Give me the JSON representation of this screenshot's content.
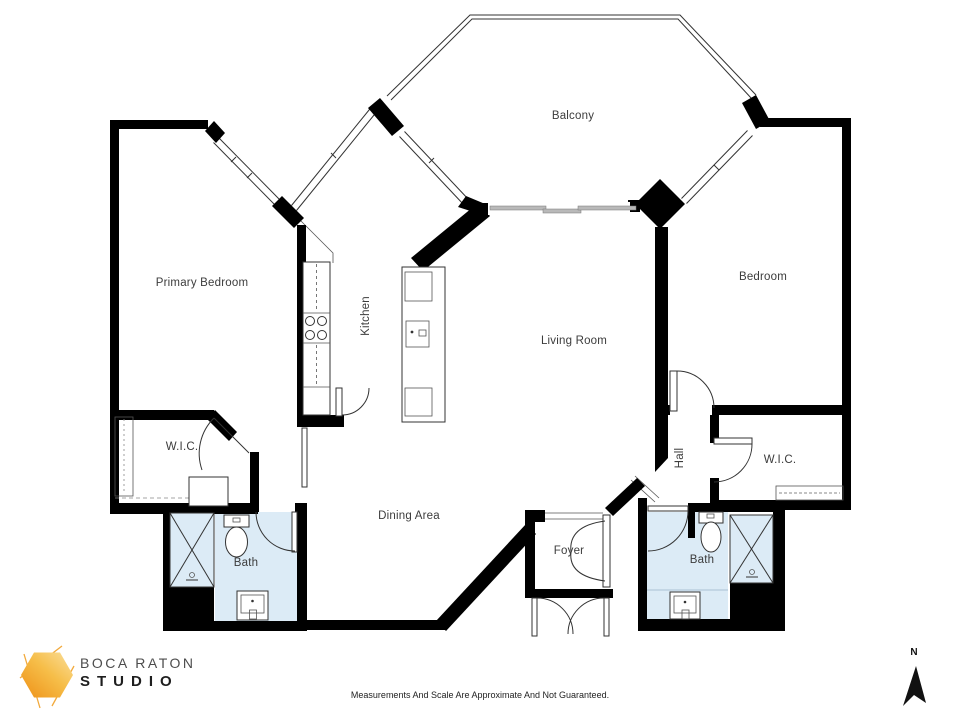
{
  "floorplan": {
    "rooms": {
      "balcony": {
        "label": "Balcony"
      },
      "primary_bedroom": {
        "label": "Primary Bedroom"
      },
      "kitchen": {
        "label": "Kitchen"
      },
      "living_room": {
        "label": "Living Room"
      },
      "bedroom": {
        "label": "Bedroom"
      },
      "wic_left": {
        "label": "W.I.C."
      },
      "wic_right": {
        "label": "W.I.C."
      },
      "bath_left": {
        "label": "Bath"
      },
      "bath_right": {
        "label": "Bath"
      },
      "dining_area": {
        "label": "Dining Area"
      },
      "foyer": {
        "label": "Foyer"
      },
      "hall": {
        "label": "Hall"
      }
    },
    "disclaimer": "Measurements And Scale Are Approximate And Not Guaranteed.",
    "compass": {
      "label": "N"
    },
    "logo": {
      "line1": "BOCA RATON",
      "line2": "STUDIO"
    },
    "colors": {
      "wall": "#000000",
      "bath_fill": "#DCEBF6",
      "sliding_door": "#B9B9B9",
      "label_text": "#3C3C3C",
      "logo_text_primary": "#4D4D4D",
      "logo_text_secondary": "#1E1E1E",
      "logo_orange_dark": "#EE9016",
      "logo_orange_light": "#FADF9C"
    }
  }
}
